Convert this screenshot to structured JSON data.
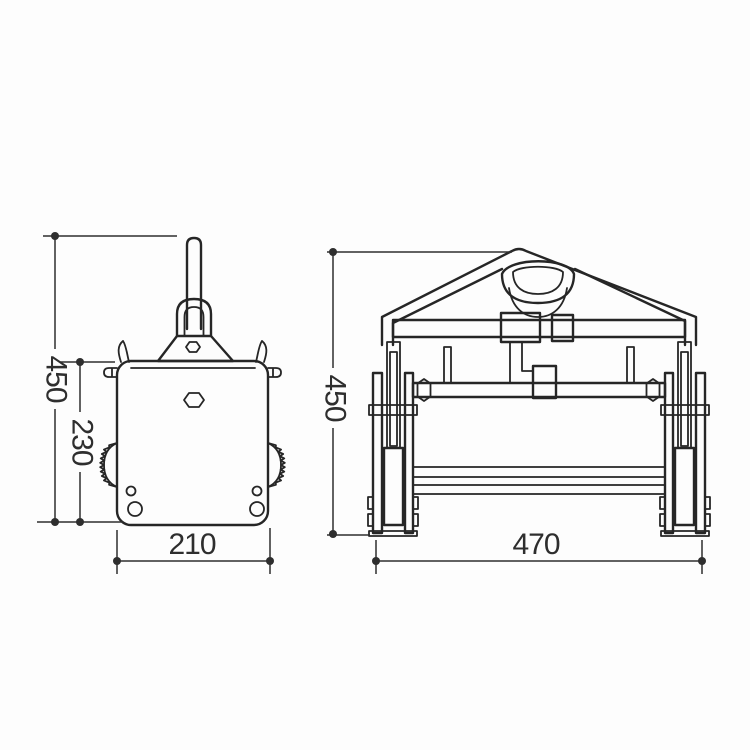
{
  "page": {
    "background": "#fdfdfd",
    "line_color": "#262626",
    "dim_line_color": "#2e2e2e"
  },
  "dims": {
    "side_overall_height": "450",
    "side_body_height": "230",
    "side_body_width": "210",
    "front_overall_height": "450",
    "front_overall_width": "470"
  }
}
